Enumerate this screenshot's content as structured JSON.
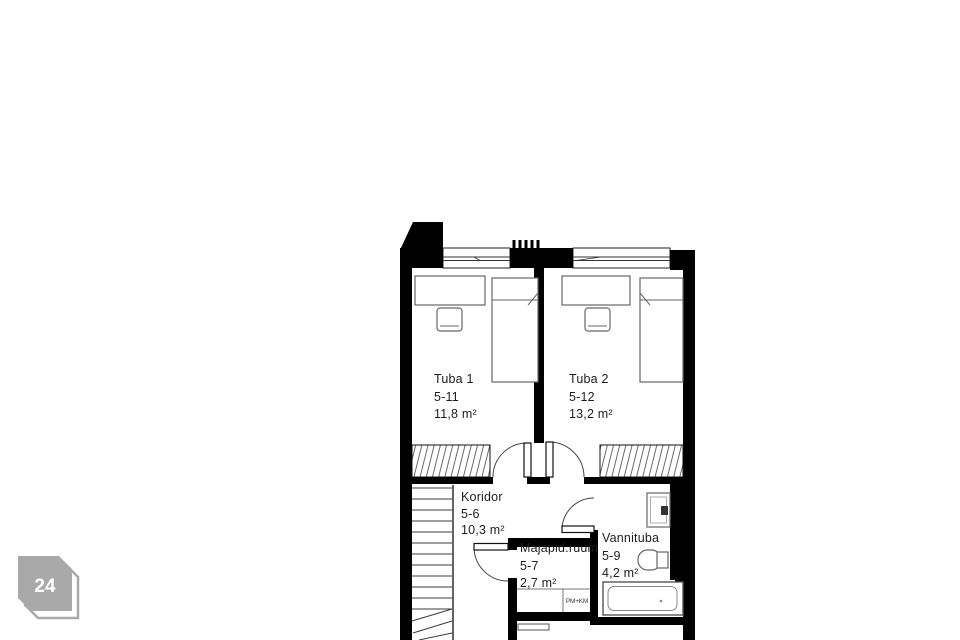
{
  "page": {
    "background": "#ffffff"
  },
  "badge": {
    "label": "24",
    "color": "#a9a9a9",
    "text_color": "#ffffff"
  },
  "floorplan": {
    "wall_color": "#000000",
    "rooms": [
      {
        "id": "tuba1",
        "name": "Tuba 1",
        "number": "5-11",
        "area": "11,8 m²"
      },
      {
        "id": "tuba2",
        "name": "Tuba 2",
        "number": "5-12",
        "area": "13,2 m²"
      },
      {
        "id": "koridor",
        "name": "Koridor",
        "number": "5-6",
        "area": "10,3 m²"
      },
      {
        "id": "majapid",
        "name": "Majapid.ruum",
        "number": "5-7",
        "area": "2,7 m²"
      },
      {
        "id": "vannituba",
        "name": "Vannituba",
        "number": "5-9",
        "area": "4,2 m²"
      }
    ],
    "annotations": [
      {
        "id": "washer",
        "label": "PM+KM"
      }
    ]
  }
}
